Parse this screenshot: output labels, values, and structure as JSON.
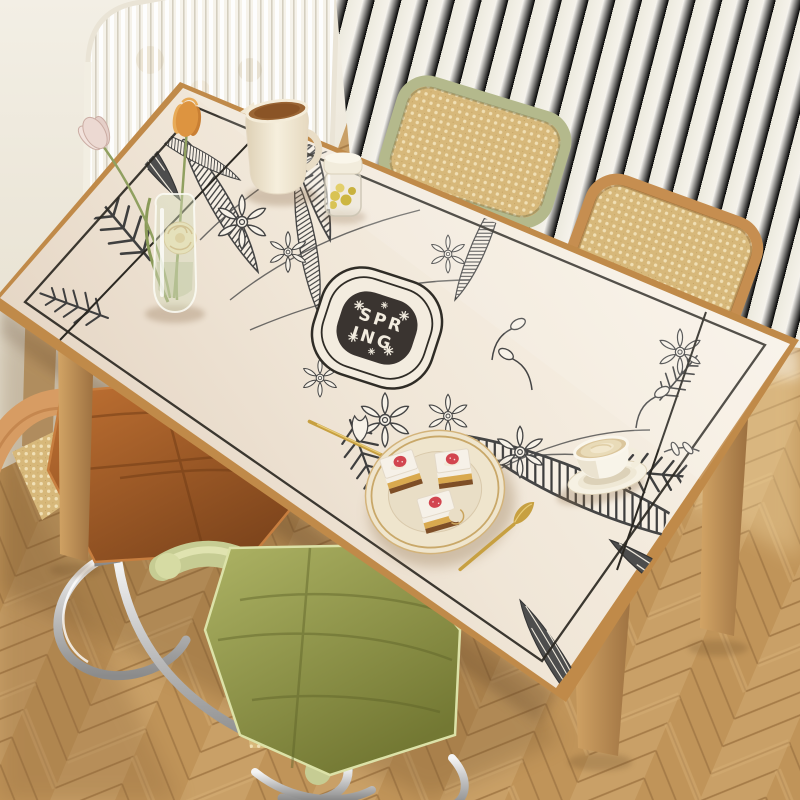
{
  "scene": {
    "description": "Photograph of a dining table covered with a cream botanical-print table mat, viewed from above at an angle",
    "medallion": {
      "word": "SPRING",
      "line1": "SPR",
      "line2": "ING",
      "bg": "#3a3430",
      "text_color": "#f2ecdf"
    },
    "palette": {
      "wall": "#f1ece1",
      "curtain": "#f8f6f0",
      "floor_plank": "#c9a067",
      "floor_joint": "#a67c48",
      "table_wood": "#c08a49",
      "mat_cream": "#f1e8da",
      "keyline": "#2b2822",
      "art_ink": "#3f3f3f",
      "rattan_cane": "#d7b87a",
      "chair_frame_green": "#b4b98c",
      "chair_frame_orange": "#c68e50",
      "cushion_orange": "#b06428",
      "cushion_green": "#a2a75e",
      "chrome": "#c9c9c9",
      "gold": "#c7a041",
      "strawberry": "#d2454f",
      "ceramic": "#f2ead8",
      "glass": "#e6e8da"
    },
    "objects": {
      "background": [
        "wall",
        "fluted-glass-panel",
        "sheer-curtain",
        "herringbone-wood-floor"
      ],
      "furniture": [
        "wood-dining-table",
        "rattan-back-chair-green",
        "rattan-back-chair-orange",
        "cantilever-chair-orange-cushion",
        "cantilever-chair-green-cushion"
      ],
      "on_table": [
        "glass-bud-vase",
        "tulips",
        "cream-rose",
        "ceramic-pitcher",
        "glass-candy-jar",
        "dessert-plate",
        "cake-slices-with-strawberry",
        "gold-fork",
        "gold-knife",
        "latte-cup-and-saucer"
      ],
      "mat_design": [
        "cream-field",
        "black-keyline-border",
        "botanical-line-art-band",
        "spring-medallion"
      ]
    }
  }
}
